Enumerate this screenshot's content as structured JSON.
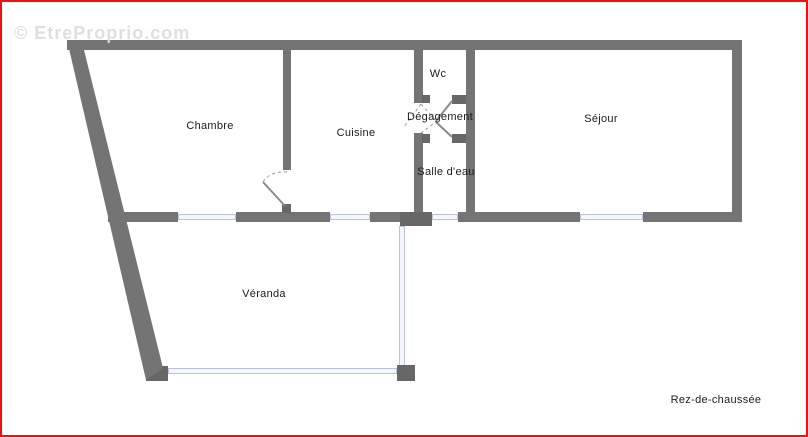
{
  "plan": {
    "watermark": "© EtreProprio.com",
    "floor_label": "Rez-de-chaussée",
    "rooms": [
      {
        "id": "chambre",
        "label": "Chambre"
      },
      {
        "id": "cuisine",
        "label": "Cuisine"
      },
      {
        "id": "wc",
        "label": "Wc"
      },
      {
        "id": "degagement",
        "label": "Dégagement"
      },
      {
        "id": "salle-deau",
        "label": "Salle d'eau"
      },
      {
        "id": "sejour",
        "label": "Séjour"
      },
      {
        "id": "veranda",
        "label": "Véranda"
      }
    ],
    "colors": {
      "wall": "#747474",
      "wall_dark": "#676767",
      "window_border": "#b9c1dd",
      "window_fill": "#f6f7fc",
      "frame": "#ee1111",
      "label": "#1c1c1c",
      "watermark": "#dcdcdc",
      "bg": "#ffffff"
    }
  }
}
